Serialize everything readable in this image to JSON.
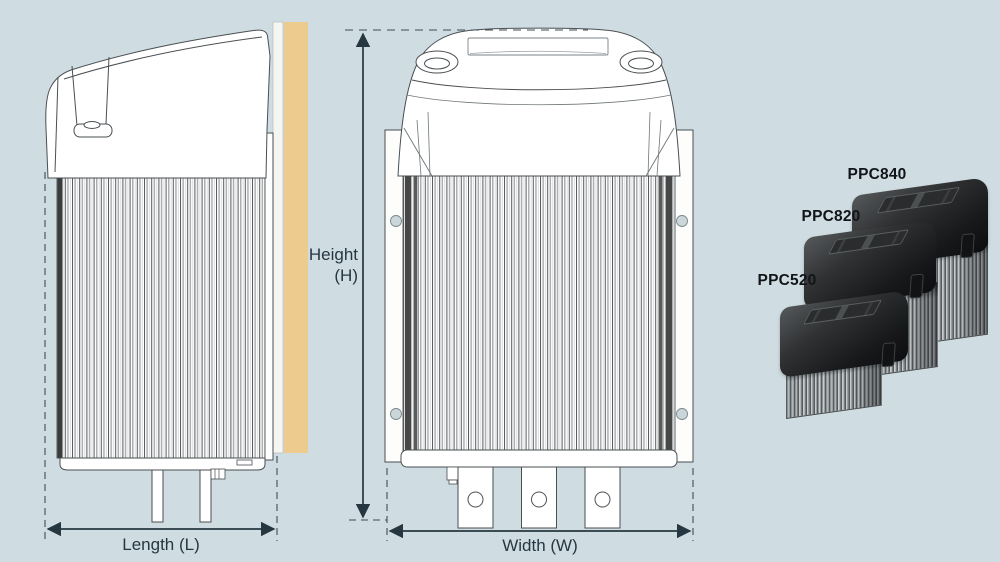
{
  "page": {
    "background_color": "#cfdde2"
  },
  "diagram": {
    "line_color": "#4a4f52",
    "dimension_color": "#273741",
    "wall_color": "#edca8e",
    "labels": {
      "height_line1": "Height",
      "height_line2": "(H)",
      "length": "Length (L)",
      "width": "Width (W)"
    }
  },
  "products": {
    "label_color": "#111518",
    "items": [
      {
        "model": "PPC840"
      },
      {
        "model": "PPC820"
      },
      {
        "model": "PPC520"
      }
    ]
  }
}
